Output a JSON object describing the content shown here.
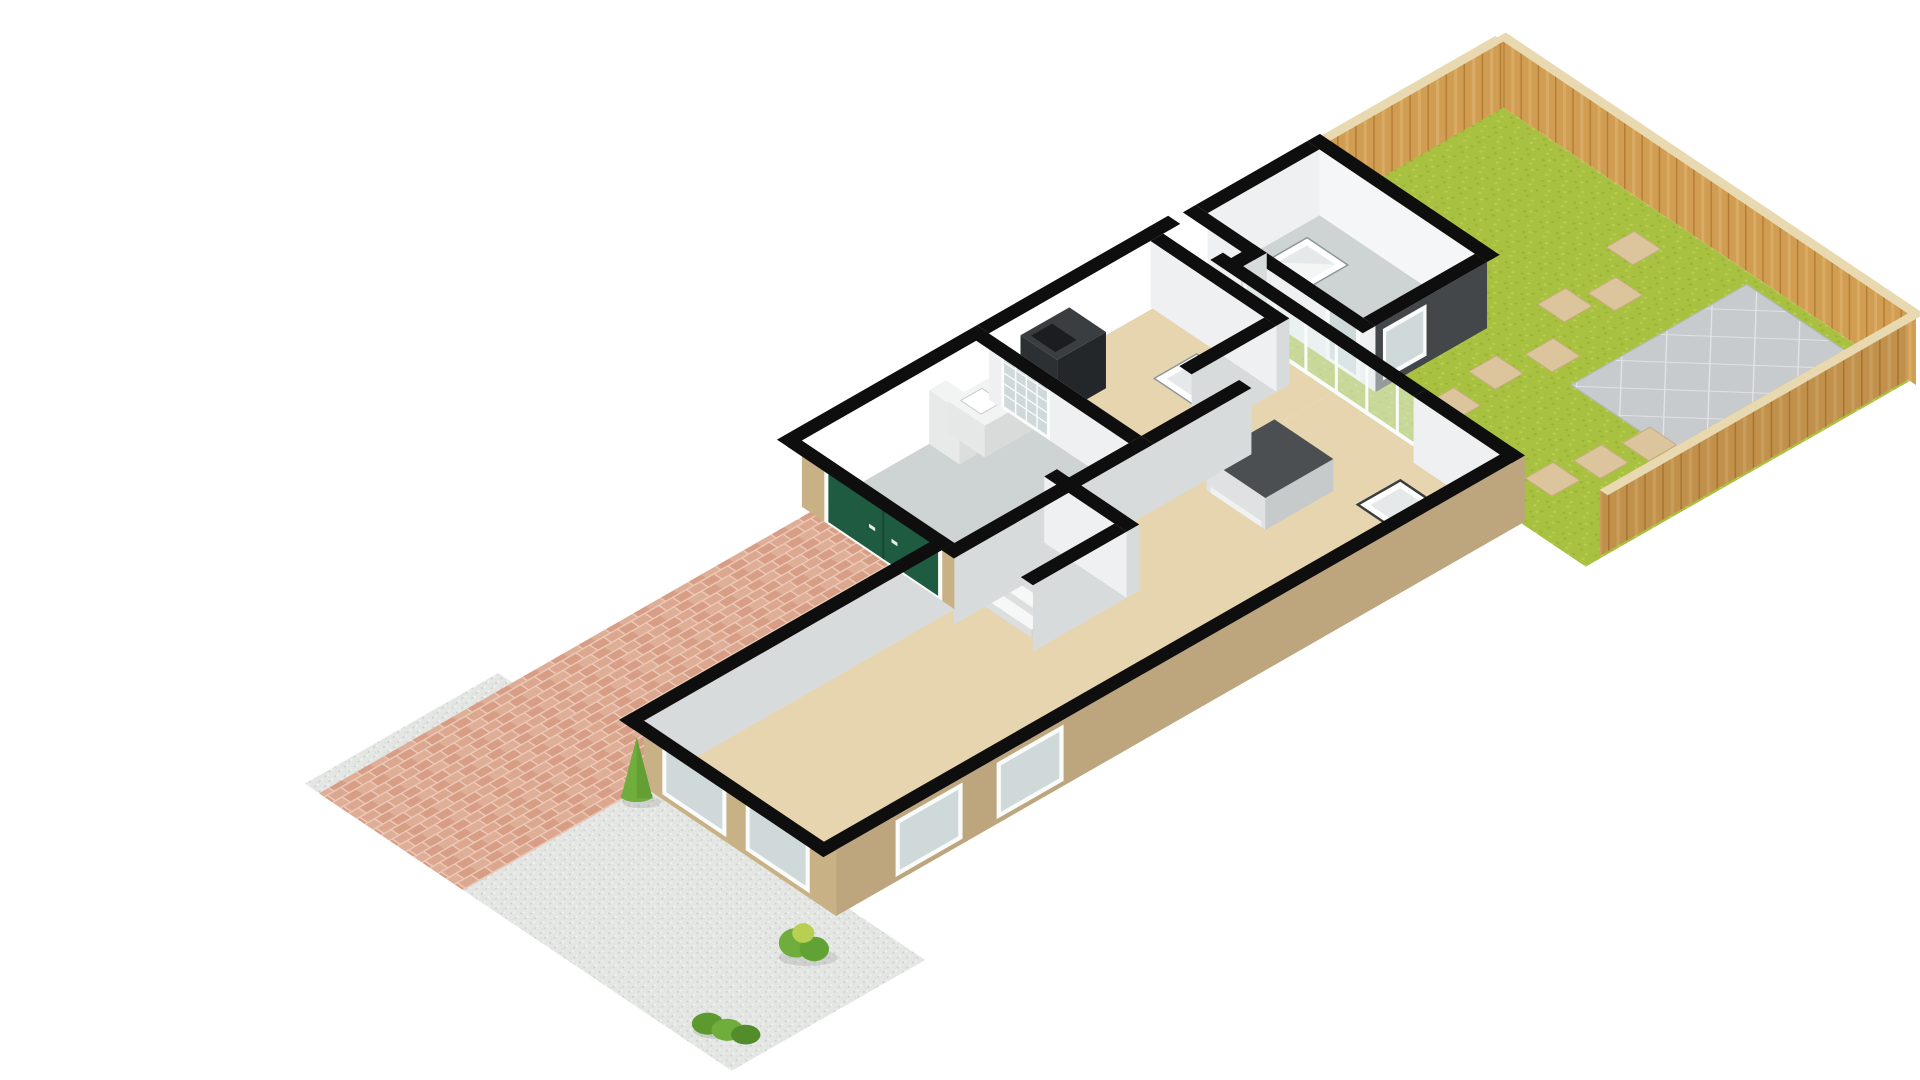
{
  "title": "3D ground floor plan with garden, garage and driveway",
  "background": "#ffffff",
  "colors": {
    "grass": "#a9c140",
    "grassLight": "#b8cf52",
    "grassDark": "#9ab336",
    "patio": "#c7cbcd",
    "patioLine": "#e3e5e6",
    "patioEdge": "#b4b9bb",
    "stone": "#dcc49c",
    "stoneEdge": "#c8ad82",
    "fenceWood": "#d09d52",
    "fenceWoodDark": "#b37d36",
    "fenceWoodLight": "#e0b472",
    "fenceTop": "#e9d9b0",
    "extWall": "#43474a",
    "cap": "#0e0e0e",
    "wallWhite": "#eef0f1",
    "wallShade": "#d8dbdc",
    "wallLight": "#f5f6f7",
    "floorBeige": "#e7d5b0",
    "floorGray": "#ced3d4",
    "stairWhite": "#f6f7f7",
    "stairShade": "#dcdfe0",
    "brickHouse": "#c9b186",
    "brickHouseShade": "#b89e73",
    "driveBrick": "#d79d85",
    "driveBrickAlt": "#dfae97",
    "driveJoint": "#ecc9b8",
    "gravel": "#e4e6e4",
    "gravelDot": "#cbcfcb",
    "gravelDot2": "#f5f6f5",
    "doorGreen": "#1f5b41",
    "doorGreenDark": "#174731",
    "glass": "#cfd9da",
    "glassClear": "#e8f0ef",
    "frameWhite": "#fafbfb",
    "unitDark": "#3a3e40",
    "unitDarker": "#2d3032",
    "counterWhite": "#f2f3f3",
    "islandTop": "#4b4f51",
    "islandSide": "#c7cacb",
    "islandFront": "#dfe1e2",
    "bushGreen": "#6fae3c",
    "bushDark": "#558e2c",
    "shadow": "#00000018",
    "diamondInner": "#e6e9ea",
    "diamondEdge": "#8f9597",
    "redItem": "#c0392b"
  },
  "parts": {
    "garden-lawn": "Garden lawn",
    "garden-patio": "Paved patio",
    "stepping-stone": "Stepping stone",
    "fence-far": "Rear garden fence",
    "fence-left": "Left garden fence",
    "fence-right": "Right garden fence",
    "gravel-yard": "Gravel front yard",
    "brick-driveway": "Brick driveway",
    "rear-extension-floor": "Rear extension room",
    "extension-skylight": "Extension rooflight",
    "extension-window": "Extension window",
    "extension-door": "Extension glazed door",
    "wc-shower-tray": "Shower tray",
    "dining-rooflight": "Rooflight panel",
    "bifold-doors": "Bifold garden doors",
    "kitchen-island": "Kitchen island",
    "kitchen-counter": "Kitchen counter",
    "kitchen-tall-unit": "Kitchen tall units",
    "internal-glazed-door": "Internal glazed door",
    "staircase-step": "Staircase",
    "garage-floor": "Garage",
    "garage-door": "Garage door",
    "front-window-1": "Front window",
    "front-window-2": "Front window",
    "side-window-1": "Side window",
    "side-window-2": "Side window",
    "bush-cone": "Conical shrub",
    "bush-round": "Garden shrub",
    "hedge": "Low hedge",
    "coat-rack": "Hall storage"
  }
}
